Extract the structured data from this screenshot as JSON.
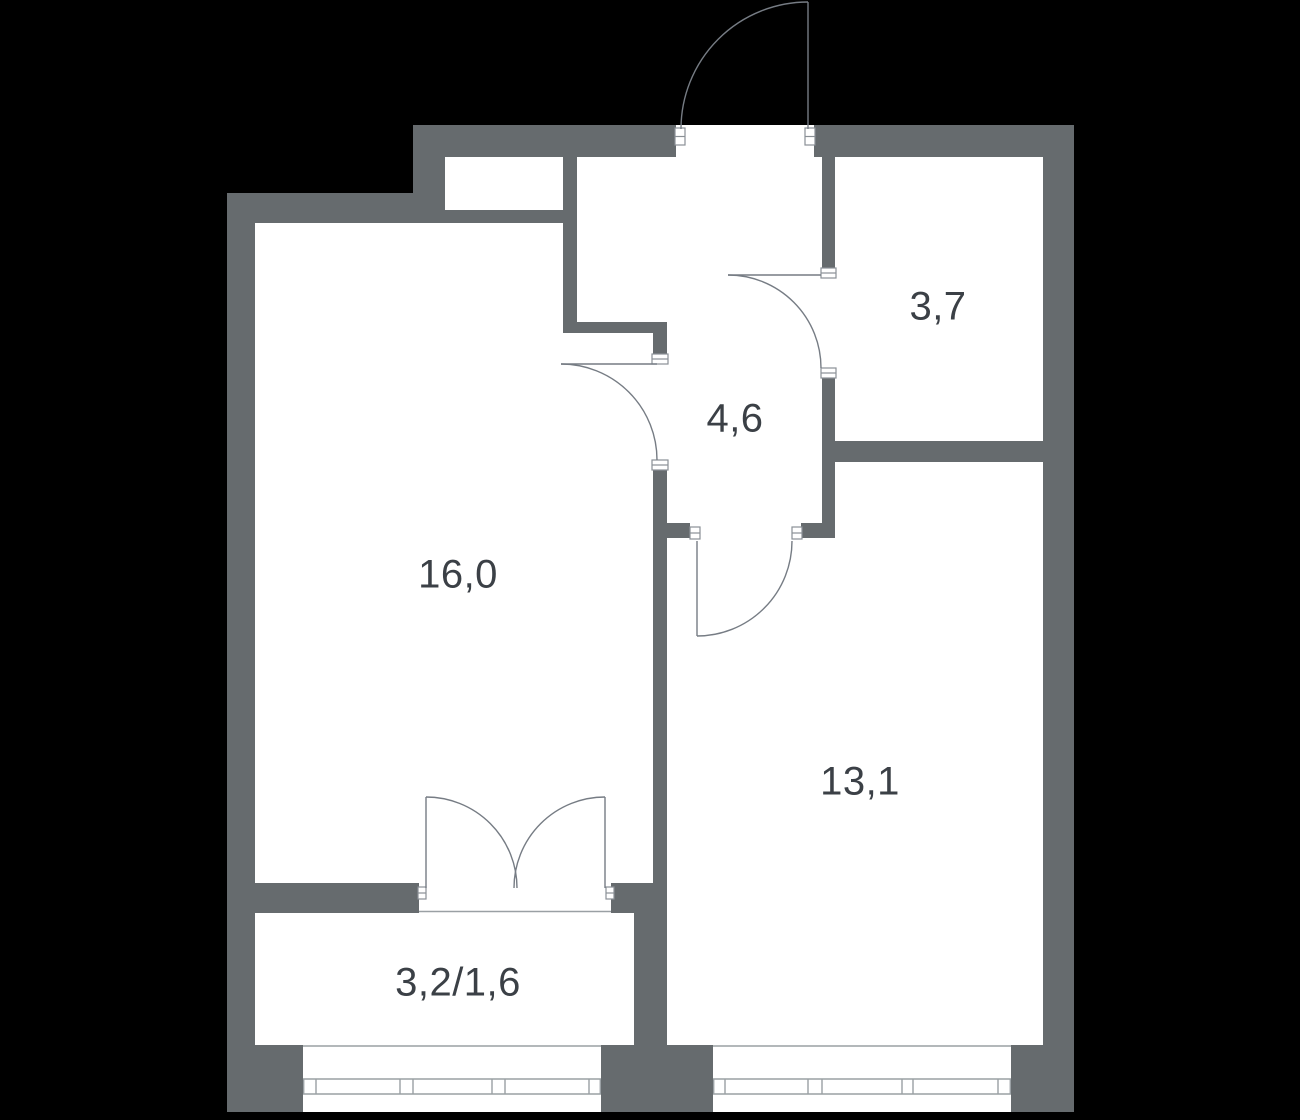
{
  "floor_plan": {
    "description": "apartment floor plan, one-room flat with hallway, bathroom, balcony",
    "colors": {
      "background": "#000000",
      "wall": "#666b6e",
      "floor": "#ffffff",
      "label_text": "#3b4046",
      "door_line": "#767c84",
      "window_line": "#9aa0a4",
      "jamb_border": "#8a9096"
    },
    "rooms": [
      {
        "name": "living-room",
        "label": "16,0"
      },
      {
        "name": "hallway",
        "label": "4,6"
      },
      {
        "name": "bathroom",
        "label": "3,7"
      },
      {
        "name": "bedroom",
        "label": "13,1"
      },
      {
        "name": "balcony",
        "label": "3,2/1,6"
      }
    ],
    "doors": [
      "entrance-door",
      "bathroom-door",
      "living-room-door",
      "bedroom-door",
      "balcony-double-door"
    ],
    "windows": [
      "balcony-window",
      "bedroom-window"
    ]
  }
}
